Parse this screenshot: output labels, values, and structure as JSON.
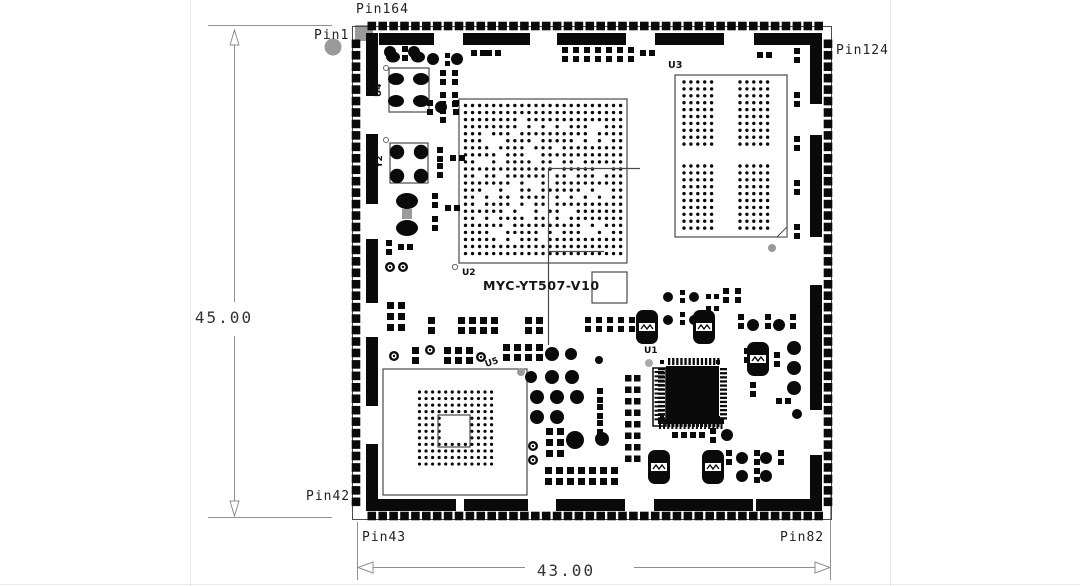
{
  "drawing": {
    "title": "MYC-YT507-V10",
    "dimensions": {
      "height": "45.00",
      "width": "43.00"
    },
    "pins": {
      "pin1": "Pin1",
      "pin42": "Pin42",
      "pin43": "Pin43",
      "pin82": "Pin82",
      "pin124": "Pin124",
      "pin164": "Pin164"
    },
    "components": {
      "u1": "U1",
      "u2": "U2",
      "u3": "U3",
      "u4": "U4",
      "u5": "U5",
      "y2": "Y2"
    },
    "colors": {
      "ink": "#0a0a0a",
      "outline": "#4a4a4a",
      "dim_line": "#8f8f8f",
      "gray_pad": "#9a9a9a",
      "page_edge": "#e7e7e7"
    }
  }
}
